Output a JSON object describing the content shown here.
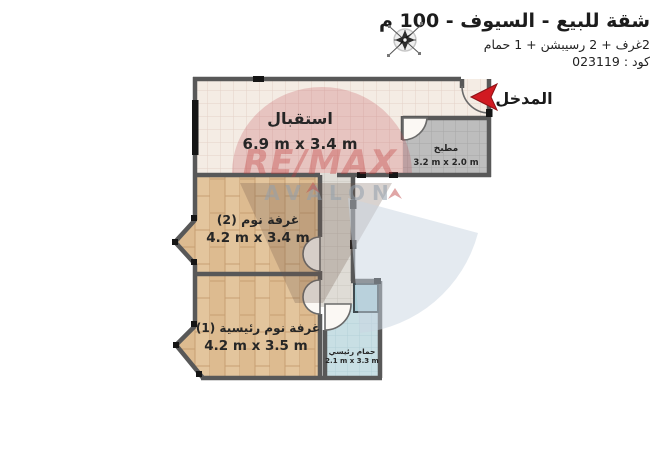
{
  "header": {
    "title": "شقة للبيع - السيوف - 100 م",
    "subtitle": "2غرف + 2 رسيبشن + 1 حمام",
    "code": "كود : 023119"
  },
  "entrance": {
    "label": "المدخل"
  },
  "rooms": {
    "reception": {
      "name": "استقبال",
      "dims": "6.9 m x 3.4 m"
    },
    "kitchen": {
      "name": "مطبخ",
      "dims": "3.2 m x 2.0 m"
    },
    "bedroom2": {
      "name": "غرفة نوم (2)",
      "dims": "4.2 m x 3.4 m"
    },
    "master": {
      "name": "غرفة نوم رئيسية (1)",
      "dims": "4.2 m x 3.5 m"
    },
    "bathroom": {
      "name": "حمام رئيسي",
      "dims": "2.1 m x 3.3 m"
    }
  },
  "watermark": {
    "line1": "RE/MAX",
    "line2": "AVALON"
  },
  "colors": {
    "wall": "#585858",
    "reception_floor": "#f4ece4",
    "kitchen_floor": "#bdbdbd",
    "corridor_floor": "#dfdcd6",
    "wood_floor": "#dfc096",
    "bathroom_floor": "#c8dfe4",
    "entrance_arrow": "#d11a21",
    "watermark_red": "#bf3a3a",
    "watermark_blue": "#c9d5e2",
    "label_text": "#262626"
  }
}
